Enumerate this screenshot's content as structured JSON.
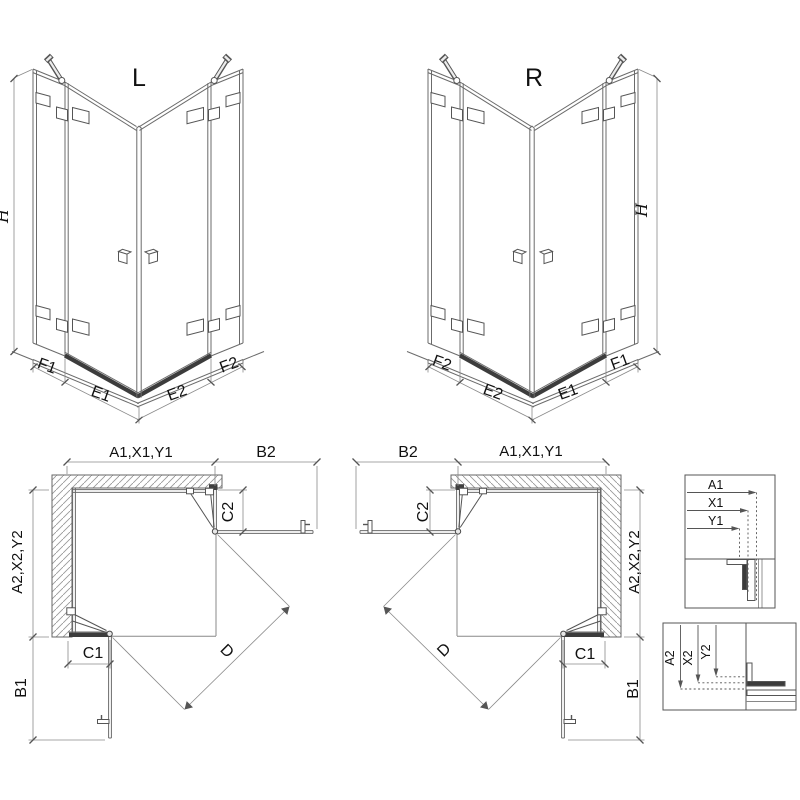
{
  "diagram": {
    "iso_left": {
      "title": "L",
      "height": "H",
      "f1": "F1",
      "e1": "E1",
      "e2": "E2",
      "f2": "F2"
    },
    "iso_right": {
      "title": "R",
      "height": "H",
      "f1": "F1",
      "e1": "E1",
      "e2": "E2",
      "f2": "F2"
    },
    "plan_left": {
      "top_width": "A1,X1,Y1",
      "door_top": "B2",
      "stub_top": "C2",
      "side_width": "A2,X2,Y2",
      "stub_bottom": "C1",
      "door_bottom": "B1",
      "diagonal": "D"
    },
    "plan_right": {
      "top_width": "A1,X1,Y1",
      "door_top": "B2",
      "stub_top": "C2",
      "side_width": "A2,X2,Y2",
      "stub_bottom": "C1",
      "door_bottom": "B1",
      "diagonal": "D"
    },
    "detail_top": {
      "a1": "A1",
      "x1": "X1",
      "y1": "Y1"
    },
    "detail_side": {
      "a2": "A2",
      "x2": "X2",
      "y2": "Y2"
    }
  }
}
